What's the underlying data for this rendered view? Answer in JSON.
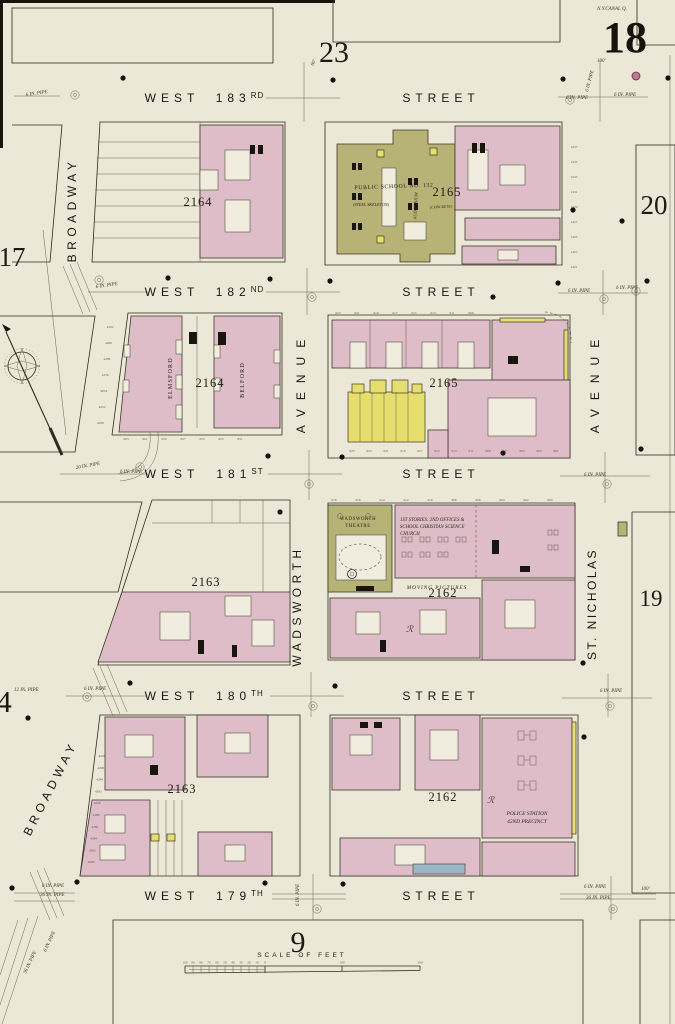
{
  "colors": {
    "paper": "#ece8d7",
    "building_pink": "#debdc8",
    "building_olive": "#b7b377",
    "building_yellow": "#e7df6d",
    "building_blue": "#9db7c7",
    "line": "#2e2b20",
    "marker_pink": "#c2788f"
  },
  "map": {
    "plate_number": "18",
    "corner_note": "N.Y.CANAL Q.",
    "adjacent_plates": {
      "top": "23",
      "right_upper": "20",
      "right_lower": "19",
      "left_upper": "17",
      "left_lower": "4",
      "bottom": "9"
    },
    "streets": [
      {
        "west": "WEST",
        "number": "183",
        "suffix": "RD",
        "street": "STREET"
      },
      {
        "west": "WEST",
        "number": "182",
        "suffix": "ND",
        "street": "STREET"
      },
      {
        "west": "WEST",
        "number": "181",
        "suffix": "ST",
        "street": "STREET"
      },
      {
        "west": "WEST",
        "number": "180",
        "suffix": "TH",
        "street": "STREET"
      },
      {
        "west": "WEST",
        "number": "179",
        "suffix": "TH",
        "street": "STREET"
      }
    ],
    "avenues": {
      "broadway_upper": "BROADWAY",
      "broadway_lower": "BROADWAY",
      "wadsworth_word": "WADSWORTH",
      "wadsworth_avenue_word": "AVENUE",
      "st_nicholas_word": "ST. NICHOLAS",
      "st_nicholas_avenue_word": "AVENUE"
    },
    "block_numbers": {
      "b2164_upper": "2164",
      "b2165_upper": "2165",
      "b2164_mid": "2164",
      "b2165_mid": "2165",
      "b2163_mid": "2163",
      "b2162_mid": "2162",
      "b2163_lower": "2163",
      "b2162_lower": "2162"
    },
    "buildings": {
      "public_school_line1": "PUBLIC SCHOOL NO. 132",
      "public_school_line2": "(STEEL SKELETON)",
      "public_school_line3": "AUDITORIUM",
      "public_school_line4": "(CONCRETE)",
      "theatre_line1": "WADSWORTH",
      "theatre_line2": "THEATRE",
      "offices_line1": "1ST STORIES: 2ND OFFICES &",
      "offices_line2": "SCHOOL CHRISTIAN SCIENCE",
      "offices_line3": "CHURCH",
      "moving_pictures": "MOVING PICTURES",
      "police_line1": "POLICE STATION",
      "police_line2": "42ND PRECINCT",
      "elmsford": "ELMSFORD",
      "belford": "BELFORD"
    },
    "scale_bar": {
      "title": "SCALE OF FEET",
      "tick_labels": [
        {
          "t": "100",
          "x": 185
        },
        {
          "t": "90",
          "x": 193
        },
        {
          "t": "80",
          "x": 201
        },
        {
          "t": "70",
          "x": 209
        },
        {
          "t": "60",
          "x": 217
        },
        {
          "t": "50",
          "x": 225
        },
        {
          "t": "40",
          "x": 233
        },
        {
          "t": "30",
          "x": 241
        },
        {
          "t": "20",
          "x": 249
        },
        {
          "t": "10",
          "x": 257
        },
        {
          "t": "0",
          "x": 265
        },
        {
          "t": "100",
          "x": 342
        },
        {
          "t": "200",
          "x": 420
        }
      ]
    },
    "pipe_labels": [
      {
        "t": "6 IN. PIPE",
        "x": 26,
        "y": 96,
        "r": -8
      },
      {
        "t": "6 IN. PIPE",
        "x": 566,
        "y": 99,
        "r": 0
      },
      {
        "t": "6 IN. PIPE",
        "x": 614,
        "y": 96,
        "r": 0
      },
      {
        "t": "6 IN. PIPE",
        "x": 588,
        "y": 92,
        "r": -75
      },
      {
        "t": "100'",
        "x": 597,
        "y": 62,
        "r": 0
      },
      {
        "t": "60'",
        "x": 313,
        "y": 66,
        "r": -60
      },
      {
        "t": "6 IN. PIPE",
        "x": 96,
        "y": 288,
        "r": -8
      },
      {
        "t": "6 IN. PIPE",
        "x": 568,
        "y": 292,
        "r": 0
      },
      {
        "t": "6 IN. PIPE",
        "x": 616,
        "y": 289,
        "r": 0
      },
      {
        "t": "20 IN. PIPE",
        "x": 76,
        "y": 469,
        "r": -10
      },
      {
        "t": "6 IN. PIPE",
        "x": 120,
        "y": 473,
        "r": 0
      },
      {
        "t": "6 IN. PIPE",
        "x": 584,
        "y": 476,
        "r": 0
      },
      {
        "t": "12 IN. PIPE",
        "x": 14,
        "y": 691,
        "r": 0
      },
      {
        "t": "6 IN. PIPE",
        "x": 84,
        "y": 690,
        "r": 0
      },
      {
        "t": "6 IN. PIPE",
        "x": 600,
        "y": 692,
        "r": 0
      },
      {
        "t": "6 IN. PIPE",
        "x": 42,
        "y": 887,
        "r": 0
      },
      {
        "t": "36 IN. PIPE",
        "x": 40,
        "y": 896,
        "r": 0
      },
      {
        "t": "6 IN. PIPE",
        "x": 299,
        "y": 906,
        "r": -90
      },
      {
        "t": "6 IN. PIPE",
        "x": 584,
        "y": 888,
        "r": 0
      },
      {
        "t": "36 IN. PIPE",
        "x": 586,
        "y": 899,
        "r": 0
      },
      {
        "t": "6 IN. PIPE",
        "x": 46,
        "y": 952,
        "r": -65
      },
      {
        "t": "36 IN. PIPE",
        "x": 26,
        "y": 974,
        "r": -65
      },
      {
        "t": "100'",
        "x": 641,
        "y": 890,
        "r": 0
      }
    ],
    "dots": [
      [
        123,
        78
      ],
      [
        333,
        80
      ],
      [
        563,
        79
      ],
      [
        668,
        78
      ],
      [
        573,
        210
      ],
      [
        622,
        221
      ],
      [
        647,
        281
      ],
      [
        558,
        283
      ],
      [
        168,
        278
      ],
      [
        270,
        279
      ],
      [
        330,
        281
      ],
      [
        493,
        297
      ],
      [
        268,
        456
      ],
      [
        342,
        457
      ],
      [
        503,
        453
      ],
      [
        641,
        449
      ],
      [
        130,
        683
      ],
      [
        335,
        686
      ],
      [
        583,
        663
      ],
      [
        280,
        512
      ],
      [
        77,
        882
      ],
      [
        265,
        883
      ],
      [
        343,
        884
      ],
      [
        28,
        718
      ],
      [
        12,
        888
      ],
      [
        584,
        737
      ]
    ],
    "utility_markers": [
      [
        75,
        95
      ],
      [
        99,
        280
      ],
      [
        140,
        467
      ],
      [
        312,
        297
      ],
      [
        309,
        484
      ],
      [
        313,
        706
      ],
      [
        317,
        909
      ],
      [
        604,
        299
      ],
      [
        607,
        484
      ],
      [
        610,
        706
      ],
      [
        613,
        909
      ],
      [
        570,
        100
      ],
      [
        87,
        697
      ],
      [
        636,
        291
      ]
    ],
    "house_number_strips": [
      {
        "x": 338,
        "y": 314,
        "dx": 19,
        "dy": 0,
        "values": [
          "623",
          "621",
          "619",
          "617",
          "615",
          "613",
          "611",
          "609"
        ]
      },
      {
        "x": 352,
        "y": 452,
        "dx": 17,
        "dy": 0,
        "values": [
          "625",
          "623",
          "621",
          "619",
          "617",
          "615",
          "613",
          "611",
          "609",
          "607",
          "605",
          "603",
          "601"
        ]
      },
      {
        "x": 334,
        "y": 501,
        "dx": 24,
        "dy": 0,
        "values": [
          "618",
          "616",
          "614",
          "612",
          "610",
          "608",
          "606",
          "604",
          "602",
          "600"
        ]
      },
      {
        "x": 126,
        "y": 440,
        "dx": 19,
        "dy": 0,
        "values": [
          "663",
          "661",
          "659",
          "657",
          "655",
          "653",
          "651"
        ]
      },
      {
        "x": 574,
        "y": 148,
        "dx": 0,
        "dy": 15,
        "values": [
          "1437",
          "1435",
          "1433",
          "1431",
          "1429",
          "1427",
          "1425",
          "1423",
          "1421"
        ]
      },
      {
        "x": 110,
        "y": 328,
        "dx": -1.6,
        "dy": 16,
        "values": [
          "4262",
          "4260",
          "4258",
          "4256",
          "4254",
          "4252",
          "4250"
        ]
      },
      {
        "x": 102,
        "y": 757,
        "dx": -1.2,
        "dy": 11.8,
        "values": [
          "4298",
          "4296",
          "4294",
          "4292",
          "4290",
          "4288",
          "4286",
          "4284",
          "4282",
          "4280"
        ]
      }
    ]
  }
}
